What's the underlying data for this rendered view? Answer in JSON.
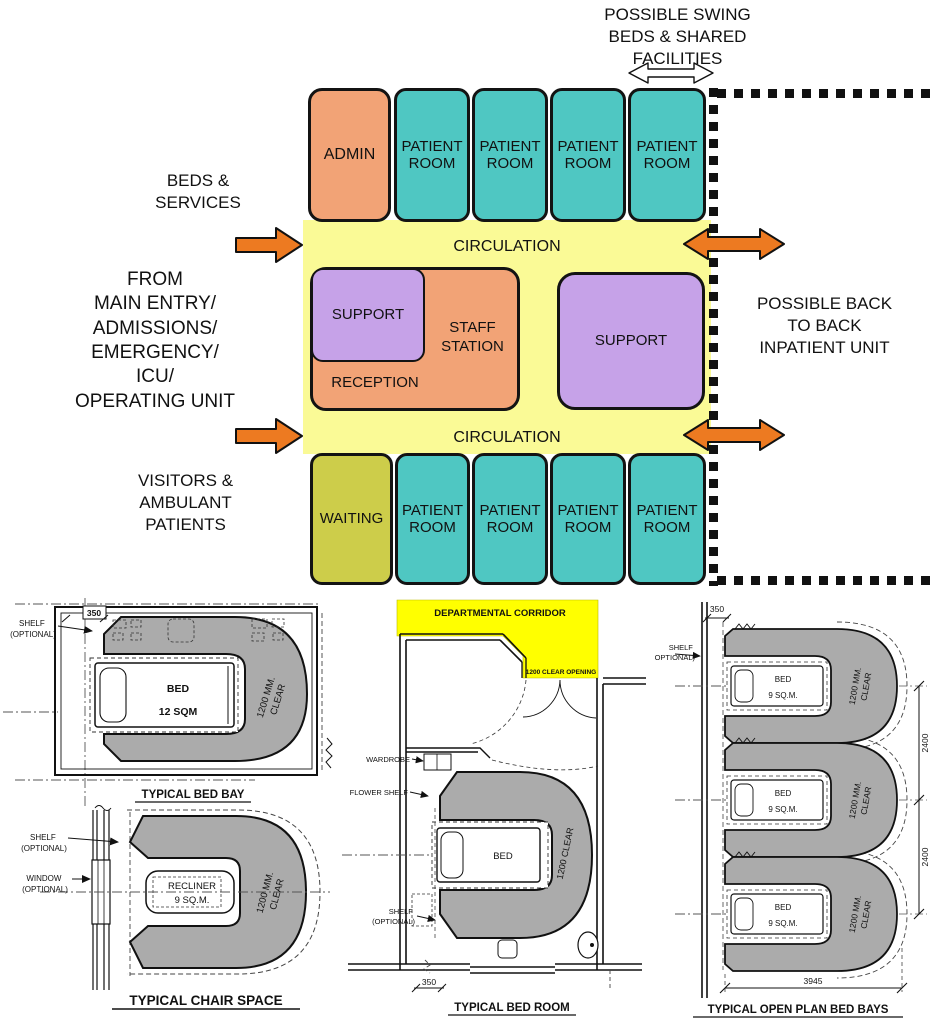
{
  "colors": {
    "patient_room_teal": "#4fc7c2",
    "admin_salmon": "#f2a376",
    "circulation_yellow": "#fafa96",
    "support_purple": "#c6a2e8",
    "waiting_olive": "#cdcd4a",
    "arrow_orange": "#ed7a21",
    "corridor_yellow": "#ffff00",
    "clear_zone_gray": "#ababab"
  },
  "unit_diagram": {
    "annotations": {
      "swing": "POSSIBLE SWING\nBEDS & SHARED\nFACILITIES",
      "beds_services": "BEDS &\nSERVICES",
      "from_main_entry": "FROM\nMAIN ENTRY/\nADMISSIONS/\nEMERGENCY/\nICU/\nOPERATING UNIT",
      "visitors": "VISITORS &\nAMBULANT\nPATIENTS",
      "back_to_back": "POSSIBLE BACK\nTO BACK\nINPATIENT UNIT"
    },
    "blocks": {
      "admin": "ADMIN",
      "patient_room": "PATIENT\nROOM",
      "circulation": "CIRCULATION",
      "support": "SUPPORT",
      "staff_station": "STAFF\nSTATION",
      "reception": "RECEPTION",
      "waiting": "WAITING"
    }
  },
  "drawings": {
    "bed_bay": {
      "title": "TYPICAL BED BAY",
      "dim_350": "350",
      "shelf_line1": "SHELF",
      "shelf_line2": "(OPTIONAL)",
      "bed_label": "BED",
      "bed_area": "12 SQM",
      "clear_line1": "1200 MM.",
      "clear_line2": "CLEAR"
    },
    "chair_space": {
      "title": "TYPICAL CHAIR SPACE",
      "shelf_line1": "SHELF",
      "shelf_line2": "(OPTIONAL)",
      "window_line1": "WINDOW",
      "window_line2": "(OPTIONAL)",
      "recliner_label": "RECLINER",
      "recliner_area": "9 SQ.M.",
      "clear_line1": "1200 MM.",
      "clear_line2": "CLEAR"
    },
    "bed_room": {
      "title": "TYPICAL BED ROOM",
      "corridor_label": "DEPARTMENTAL CORRIDOR",
      "clear_opening": "1200 CLEAR OPENING",
      "wardrobe_label": "WARDROBE",
      "flower_shelf_label": "FLOWER SHELF",
      "shelf_line1": "SHELF",
      "shelf_line2": "(OPTIONAL)",
      "bed_label": "BED",
      "clear_label": "1200 CLEAR",
      "dim_350": "350"
    },
    "open_plan": {
      "title": "TYPICAL OPEN PLAN BED BAYS",
      "dim_350": "350",
      "shelf_line1": "SHELF",
      "shelf_line2": "(OPTIONAL)",
      "bed_label": "BED",
      "bed_area": "9 SQ.M.",
      "clear_line1": "1200 MM.",
      "clear_line2": "CLEAR",
      "dim_2400": "2400",
      "dim_3945": "3945"
    }
  }
}
